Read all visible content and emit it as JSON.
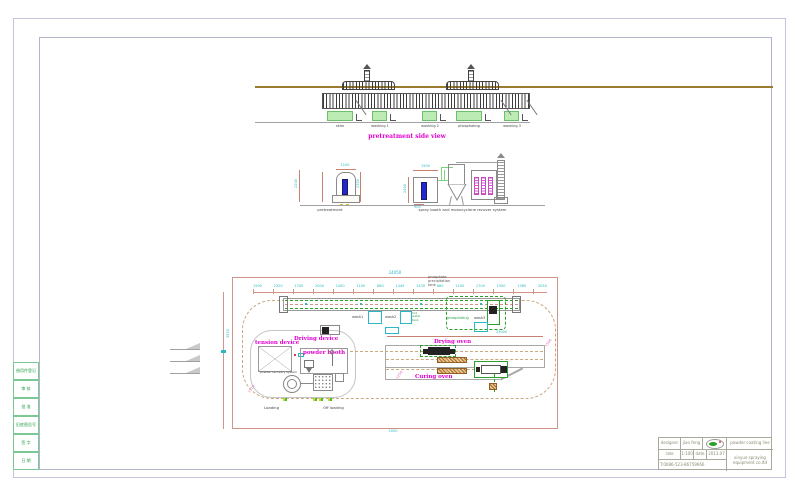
{
  "sheet": {
    "bg": "#ffffff"
  },
  "left_strip": {
    "cells": [
      "借用件登记",
      "审 核",
      "批 准",
      "旧底图总号",
      "签 字",
      "日 期"
    ]
  },
  "side_view": {
    "title": "pretreatment side view",
    "tank_labels": [
      "skim",
      "washing 1",
      "washing 2",
      "phosphating",
      "washing 3"
    ]
  },
  "front_view": {
    "pretreat_label": "pretreatment",
    "spray_label": "spray booth and monocyclone recover system",
    "dims": {
      "pretreat_top": "1100",
      "pretreat_left": "2200",
      "pretreat_right": "2350",
      "booth_top": "1500",
      "booth_left": "2400",
      "booth_bottom": "900"
    }
  },
  "plan": {
    "overall_dim": "24050",
    "chain": [
      "1500",
      "2320",
      "1700",
      "2000",
      "1450",
      "1100",
      "880",
      "1445",
      "1435",
      "880",
      "1100",
      "1700",
      "1500",
      "1360",
      "2050"
    ],
    "note_lines": [
      "phosphate",
      "precipitation",
      "tank"
    ],
    "hot_tank_lines": [
      "hot",
      "water",
      "tank"
    ],
    "labels": {
      "wash1": "wash1",
      "wash2": "wash2",
      "phosphating": "phosphating",
      "wash3": "wash3",
      "driving": "Driving device",
      "tension": "tension device",
      "booth": "powder booth",
      "recovery": "powder recovery system",
      "drying": "Drying oven",
      "curing": "Curing oven",
      "loading": "Loading",
      "offloading": "Off loading"
    },
    "dims": {
      "drying": "23000",
      "bottom": "2000",
      "left": "3550",
      "diag_right": "1560",
      "diag_left": "1710",
      "diag_mid": "1250"
    }
  },
  "title_block": {
    "designer_label": "designer",
    "designer_value": "jiao feng",
    "rate_label": "rate",
    "rate_value": "1:100",
    "date_label": "date",
    "date_value": "2013.07",
    "phone": "T:0086-523-86759666",
    "product": "powder coating line",
    "company_line1": "xinyue spraying",
    "company_line2": "equipment co.ltd"
  }
}
